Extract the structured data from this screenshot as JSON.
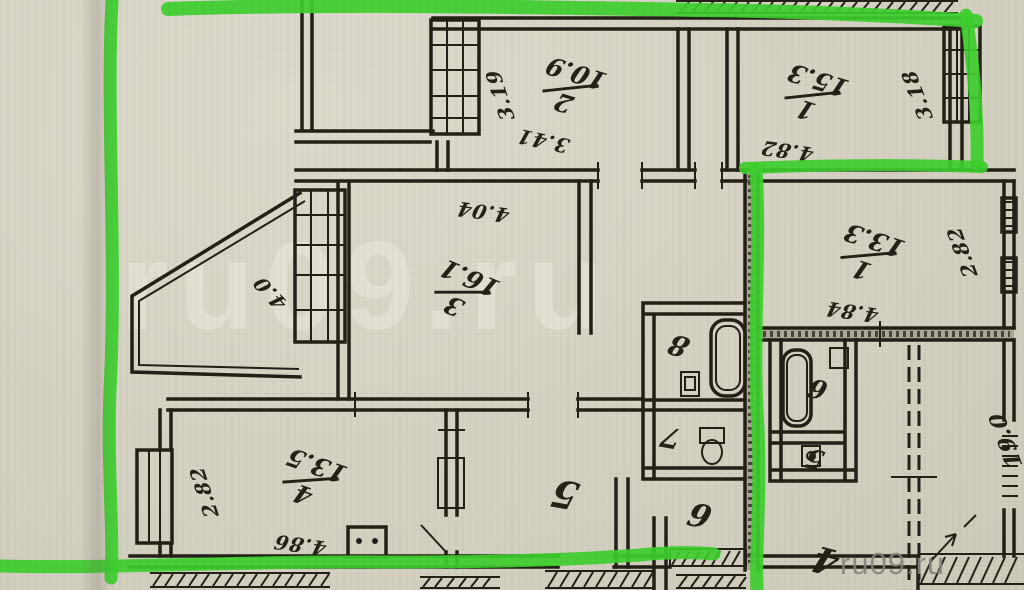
{
  "document": {
    "watermark_large": "ru09.ru",
    "watermark_small": "ru09.ru"
  },
  "highlight": {
    "color": "#3ccf2d"
  },
  "left_apartment": {
    "room1": {
      "number": "1",
      "area": "15.3",
      "width": "4.82",
      "depth": "3.18"
    },
    "room2": {
      "number": "2",
      "area": "10.9",
      "width": "3.41",
      "depth": "3.19"
    },
    "room3": {
      "number": "3",
      "area": "16.1",
      "width": "4.04",
      "depth": "4.0"
    },
    "room4": {
      "number": "4",
      "area": "13.5",
      "width": "4.86",
      "depth": "2.82"
    },
    "room5": {
      "number": "5"
    },
    "room6": {
      "number": "6"
    },
    "room7": {
      "number": "7"
    },
    "room8": {
      "number": "8"
    }
  },
  "right_apartment": {
    "room1": {
      "number": "1",
      "area": "13.3",
      "width": "4.84",
      "depth": "2.82"
    },
    "room4": {
      "number": "4"
    },
    "room5": {
      "number": "5"
    },
    "room6": {
      "number": "6"
    },
    "side_room": {
      "area": "19.0"
    }
  }
}
